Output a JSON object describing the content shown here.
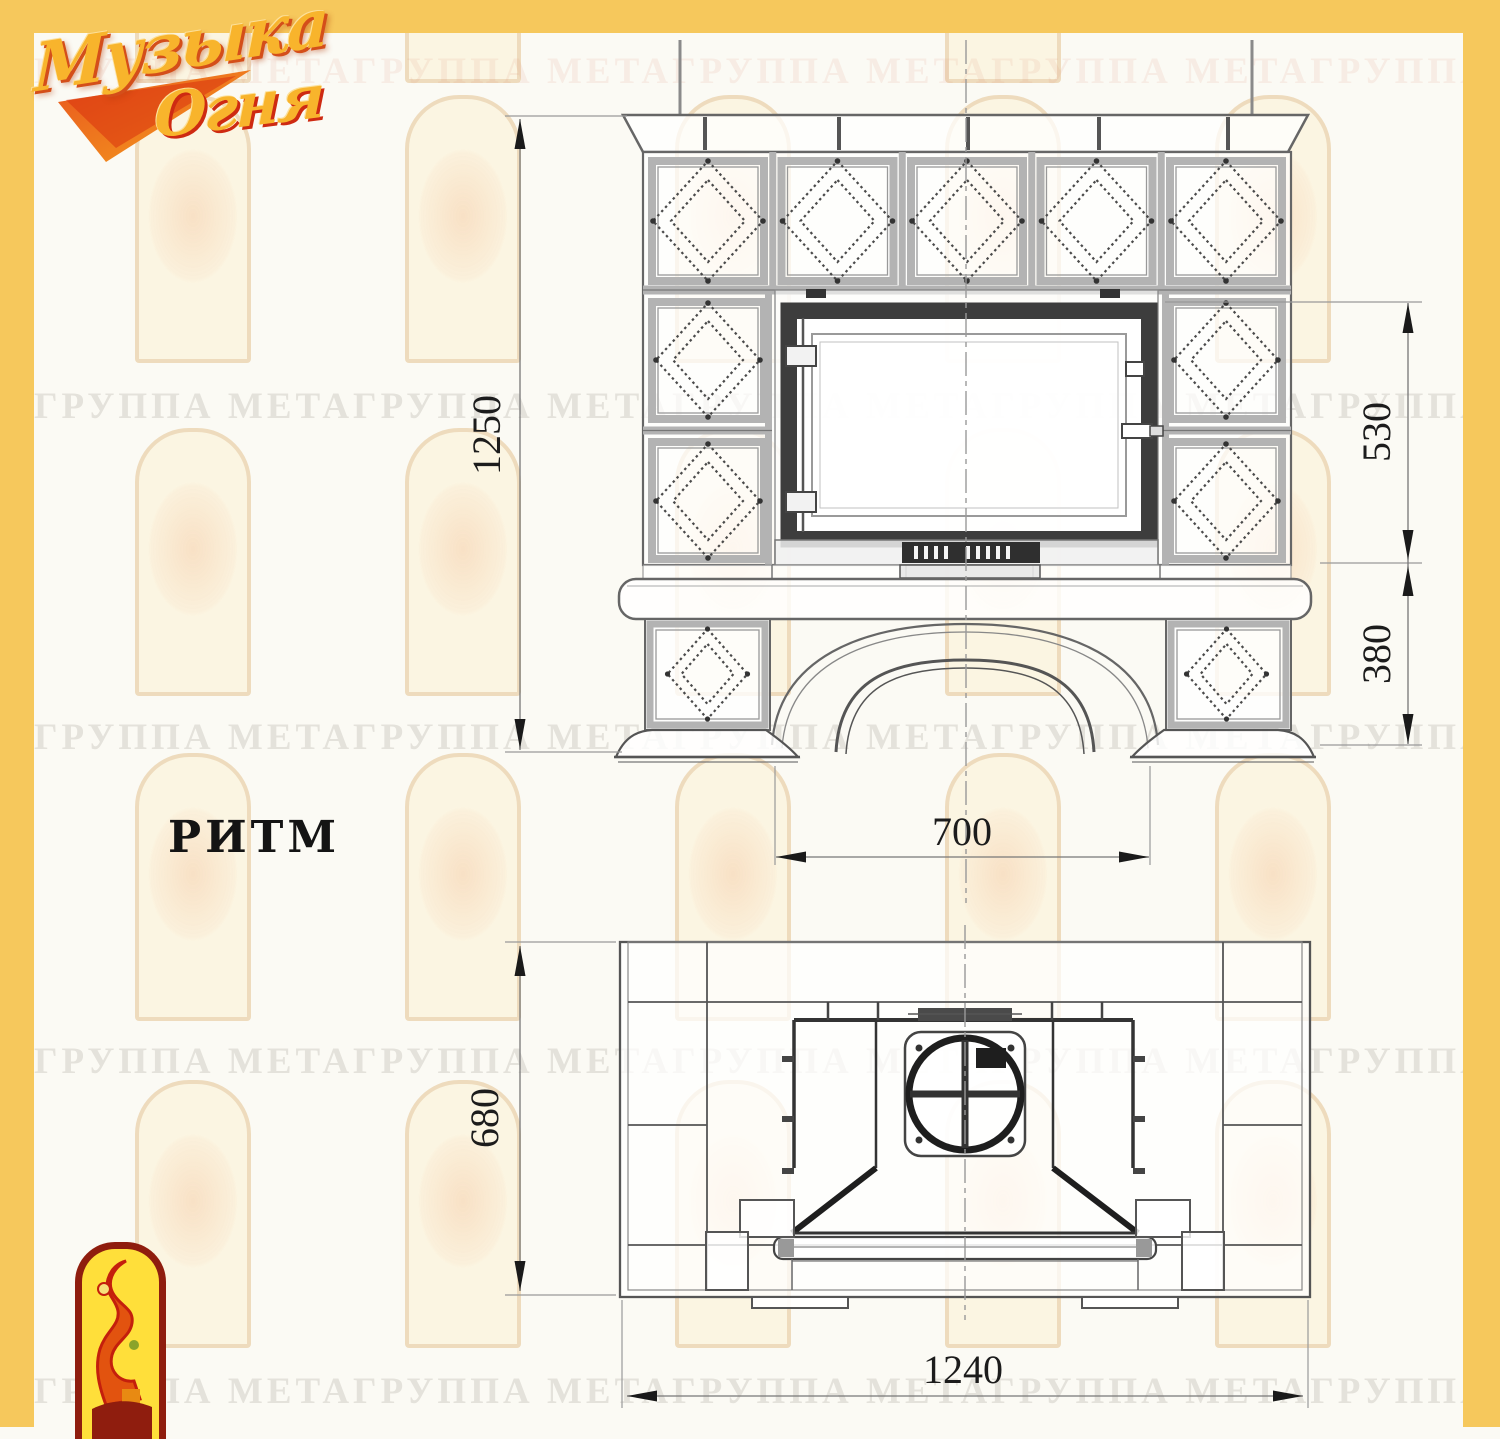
{
  "page": {
    "accent_color": "#F6C85C",
    "line_color": "#555555",
    "model_label": "РИТМ",
    "watermark_text": "ГРУППА МЕТАГРУППА МЕТАГРУППА МЕТАГРУППА МЕТАГРУППА МЕТАГРУППА МЕТА"
  },
  "logo": {
    "word1": "Музыка",
    "word2": "Огня"
  },
  "front_view": {
    "dimensions": {
      "overall_height": "1250",
      "firebox_height": "530",
      "base_height": "380",
      "opening_width": "700"
    }
  },
  "plan_view": {
    "dimensions": {
      "depth": "680",
      "overall_width": "1240"
    }
  }
}
